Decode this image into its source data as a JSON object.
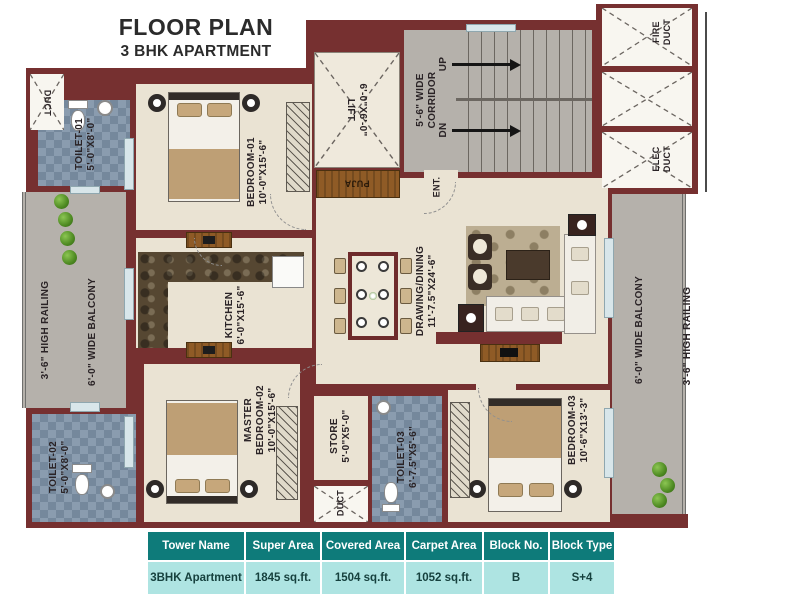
{
  "title": {
    "main": "FLOOR PLAN",
    "sub": "3 BHK APARTMENT"
  },
  "rooms": {
    "toilet1": {
      "name": "TOILET-01",
      "dim": "5'-0\"X8'-0\""
    },
    "toilet2": {
      "name": "TOILET-02",
      "dim": "5'-0\"X8'-0\""
    },
    "toilet3": {
      "name": "TOILET-03",
      "dim": "6'-7.5\"X5'-6\""
    },
    "bedroom1": {
      "name": "BEDROOM-01",
      "dim": "10'-0\"X15'-6\""
    },
    "bedroom3": {
      "name": "BEDROOM-03",
      "dim": "10'-6\"X13'-3\""
    },
    "master": {
      "line1": "MASTER",
      "line2": "BEDROOM-02",
      "dim": "10'-0\"X15'-6\""
    },
    "kitchen": {
      "name": "KITCHEN",
      "dim": "6'-0\"X15'-6\""
    },
    "drawing": {
      "name": "DRAWING/DINING",
      "dim": "11'-7.5\"X24'-6\""
    },
    "store": {
      "name": "STORE",
      "dim": "5'-0\"X5'-0\""
    },
    "lift": {
      "name": "LIFT",
      "dim": "6'-0\"X6'-0\""
    },
    "corridor": {
      "line1": "5'-6\" WIDE",
      "line2": "CORRIDOR"
    },
    "stairs": {
      "up": "UP",
      "dn": "DN"
    },
    "fire_duct": {
      "line1": "FIRE",
      "line2": "DUCT"
    },
    "elec_duct": {
      "line1": "ELEC",
      "line2": "DUCT"
    },
    "duct": "DUCT",
    "puja": "PUJA",
    "entrance": "ENT.",
    "balcony": "6'-0\" WIDE BALCONY",
    "railing": "3'-6\" HIGH RAILING"
  },
  "table": {
    "headers": [
      "Tower Name",
      "Super Area",
      "Covered Area",
      "Carpet Area",
      "Block No.",
      "Block Type"
    ],
    "row": [
      "3BHK Apartment",
      "1845 sq.ft.",
      "1504 sq.ft.",
      "1052 sq.ft.",
      "B",
      "S+4"
    ]
  },
  "colors": {
    "wall": "#763030",
    "floor": "#EAE3D3",
    "corridor_gray": "#B5B1AB",
    "toilet_tile": "#8A9CAF",
    "wood": "#8F5B26",
    "table_header": "#0E7B7A",
    "table_row": "#AEE4E2"
  }
}
